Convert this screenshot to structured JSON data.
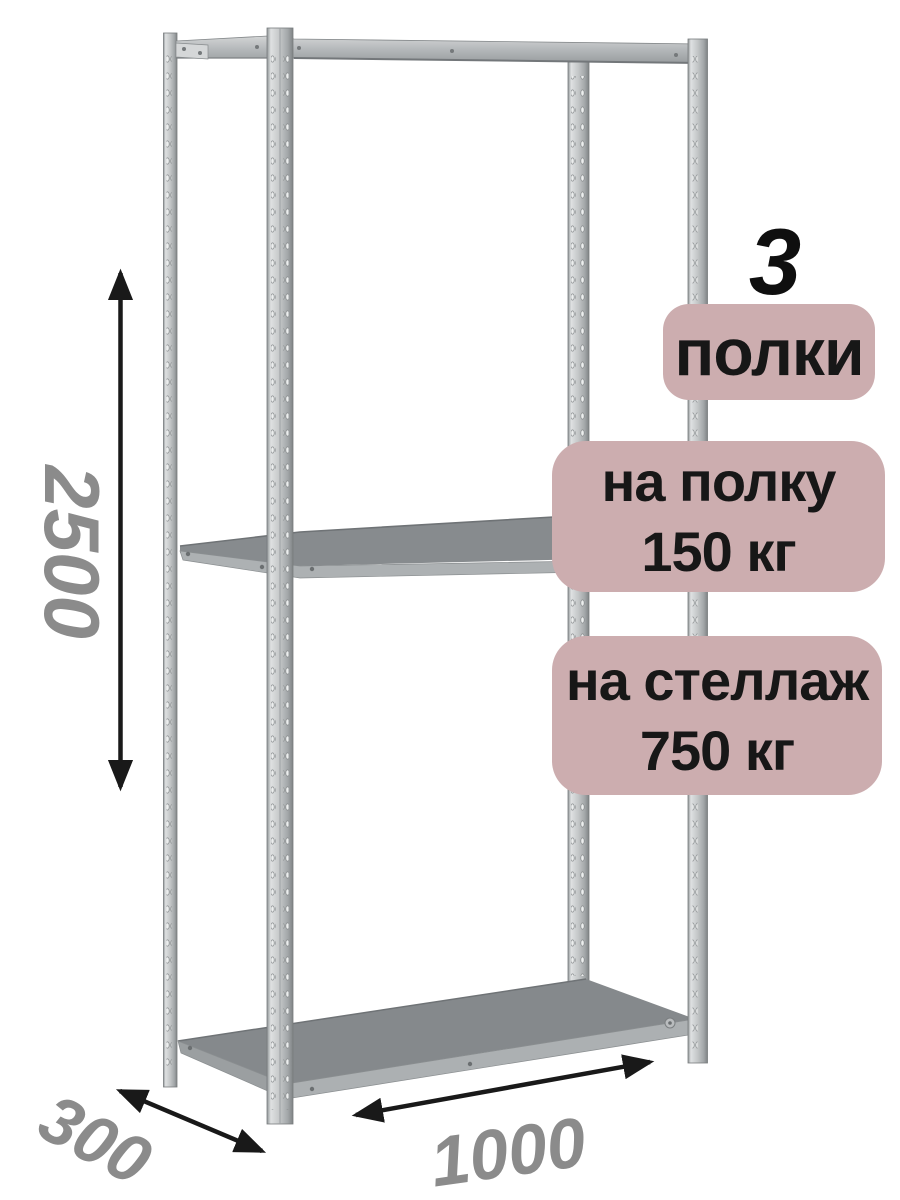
{
  "badges": {
    "shelves": {
      "count": "3",
      "label": "полки"
    },
    "per_shelf": {
      "line1": "на полку",
      "line2": "150 кг"
    },
    "per_rack": {
      "line1": "на стеллаж",
      "line2": "750 кг"
    }
  },
  "dimensions": {
    "height": "2500",
    "depth": "300",
    "width": "1000"
  },
  "icons": {
    "height_arrow": "double-headed-vertical-arrow",
    "depth_arrow": "double-headed-diagonal-arrow",
    "width_arrow": "double-headed-diagonal-arrow"
  },
  "colors": {
    "background": "#ffffff",
    "badge_bg": "#ccadaf",
    "badge_text": "#171717",
    "dimension_text": "#8b8b8b",
    "arrow": "#191919",
    "metal_light": "#dfe1e2",
    "metal_mid": "#b7babc",
    "shelf_top": "#85898c"
  }
}
